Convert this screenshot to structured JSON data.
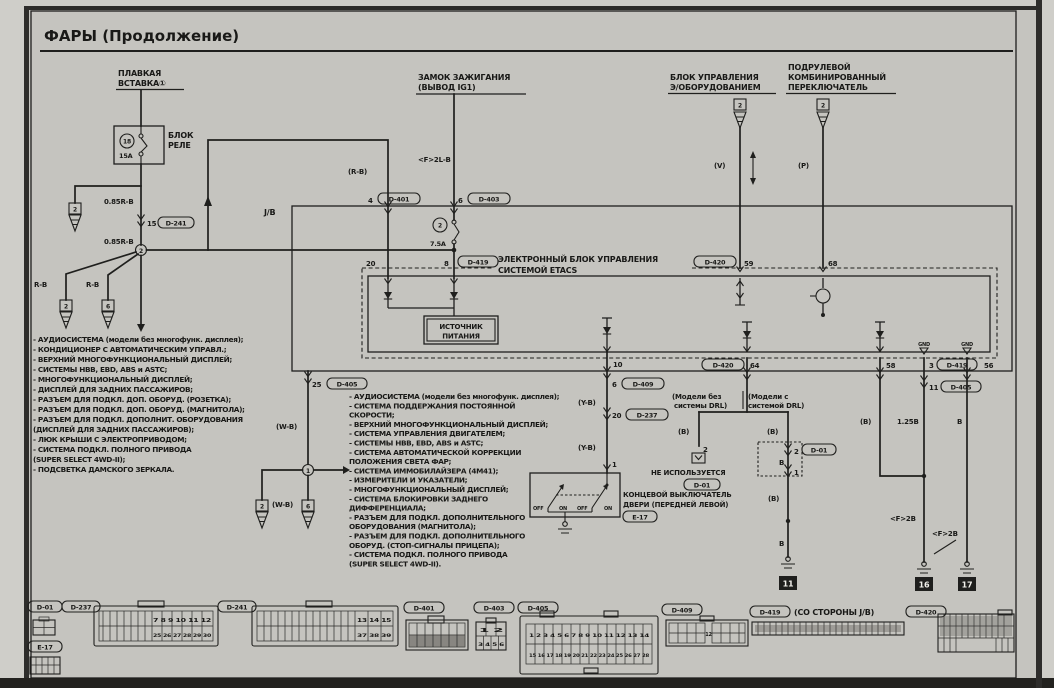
{
  "page": {
    "title": "ФАРЫ (Продолжение)"
  },
  "comp": {
    "fusible1": "ПЛАВКАЯ",
    "fusible2": "ВСТАВКА①",
    "relay1": "БЛОК",
    "relay2": "РЕЛЕ",
    "relay_fuse_no": "18",
    "relay_fuse_a": "15A",
    "ign1": "ЗАМОК ЗАЖИГАНИЯ",
    "ign2": "(ВЫВОД IG1)",
    "ecu1": "БЛОК УПРАВЛЕНИЯ",
    "ecu2": "Э/ОБОРУДОВАНИЕМ",
    "ecu_pin": "2",
    "col1": "ПОДРУЛЕВОЙ",
    "col2": "КОМБИНИРОВАННЫЙ",
    "col3": "ПЕРЕКЛЮЧАТЕЛЬ",
    "col_pin": "2",
    "jb": "J/B",
    "fuse2_no": "2",
    "fuse2_a": "7.5A",
    "etacs1": "ЭЛЕКТРОННЫЙ БЛОК УПРАВЛЕНИЯ",
    "etacs2": "СИСТЕМОЙ ETACS",
    "ps1": "ИСТОЧНИК",
    "ps2": "ПИТАНИЯ",
    "drl_a1": "(Модели без",
    "drl_a2": "системы DRL)",
    "drl_b1": "(Модели с",
    "drl_b2": "системой DRL)",
    "notused": "НЕ ИСПОЛЬЗУЕТСЯ",
    "notused_ref": "D-01",
    "door1": "КОНЦЕВОЙ ВЫКЛЮЧАТЕЛЬ",
    "door2": "ДВЕРИ (ПЕРЕДНЕЙ ЛЕВОЙ)",
    "door_ref": "E-17",
    "sw_off": "OFF",
    "sw_on": "ON",
    "gnd": "GND",
    "branch2": "2",
    "branch6": "6"
  },
  "wires": {
    "w085a": "0.85R-B",
    "w085b": "0.85R-B",
    "rb_l": "R-B",
    "rb_r": "R-B",
    "rb_p": "(R-B)",
    "f2lb": "<F>2L-B",
    "v": "(V)",
    "p": "(P)",
    "wb": "(W-B)",
    "yb": "(Y-B)",
    "b_par": "(B)",
    "b": "B",
    "b125": "1.25B",
    "f2b": "<F>2B"
  },
  "pins": {
    "p4": "4",
    "c401": "D-401",
    "p6": "6",
    "c403": "D-403",
    "p15": "15",
    "c241": "D-241",
    "p20": "20",
    "p8": "8",
    "c419": "D-419",
    "p59": "59",
    "c420": "D-420",
    "p68": "68",
    "p10": "10",
    "p6b": "6",
    "c409": "D-409",
    "p20b": "20",
    "c237": "D-237",
    "p1door": "1",
    "p25": "25",
    "c405": "D-405",
    "p64": "64",
    "p58": "58",
    "p3": "3",
    "p56": "56",
    "p11": "11",
    "p2a": "2",
    "p2b": "2",
    "c01": "D-01",
    "p1b": "1"
  },
  "grounds": {
    "g11": "11",
    "g16": "16",
    "g17": "17"
  },
  "lists": {
    "left": {
      "items": [
        "- АУДИОСИСТЕМА (модели без многофунк. дисплея);",
        "- КОНДИЦИОНЕР С АВТОМАТИЧЕСКИМ УПРАВЛ.;",
        "- ВЕРХНИЙ МНОГОФУНКЦИОНАЛЬНЫЙ ДИСПЛЕЙ;",
        "- СИСТЕМЫ HBB, EBD, ABS и ASTC;",
        "- МНОГОФУНКЦИОНАЛЬНЫЙ ДИСПЛЕЙ;",
        "- ДИСПЛЕЙ ДЛЯ ЗАДНИХ ПАССАЖИРОВ;",
        "- РАЗЪЕМ ДЛЯ ПОДКЛ. ДОП. ОБОРУД. (РОЗЕТКА);",
        "- РАЗЪЕМ ДЛЯ ПОДКЛ. ДОП. ОБОРУД. (МАГНИТОЛА);",
        "- РАЗЪЕМ ДЛЯ ПОДКЛ. ДОПОЛНИТ. ОБОРУДОВАНИЯ",
        "  (ДИСПЛЕЙ ДЛЯ ЗАДНИХ ПАССАЖИРОВ);",
        "- ЛЮК КРЫШИ С ЭЛЕКТРОПРИВОДОМ;",
        "- СИСТЕМА ПОДКЛ. ПОЛНОГО ПРИВОДА",
        "  (SUPER SELECT 4WD-II);",
        "- ПОДСВЕТКА ДАМСКОГО ЗЕРКАЛА."
      ]
    },
    "middle": {
      "items": [
        "- АУДИОСИСТЕМА (модели без многофунк. дисплея);",
        "- СИСТЕМА ПОДДЕРЖАНИЯ ПОСТОЯННОЙ",
        "  СКОРОСТИ;",
        "- ВЕРХНИЙ МНОГОФУНКЦИОНАЛЬНЫЙ ДИСПЛЕЙ;",
        "- СИСТЕМА УПРАВЛЕНИЯ ДВИГАТЕЛЕМ;",
        "- СИСТЕМЫ HBB, EBD, ABS и ASTC;",
        "- СИСТЕМА АВТОМАТИЧЕСКОЙ КОРРЕКЦИИ",
        "  ПОЛОЖЕНИЯ СВЕТА ФАР;",
        "- СИСТЕМА ИММОБИЛАЙЗЕРА (4M41);",
        "- ИЗМЕРИТЕЛИ И УКАЗАТЕЛИ;",
        "- МНОГОФУНКЦИОНАЛЬНЫЙ ДИСПЛЕЙ;",
        "- СИСТЕМА БЛОКИРОВКИ ЗАДНЕГО",
        "  ДИФФЕРЕНЦИАЛА;",
        "- РАЗЪЕМ ДЛЯ ПОДКЛ. ДОПОЛНИТЕЛЬНОГО",
        "  ОБОРУДОВАНИЯ (МАГНИТОЛА);",
        "- РАЗЪЕМ ДЛЯ ПОДКЛ. ДОПОЛНИТЕЛЬНОГО",
        "  ОБОРУД. (СТОП-СИГНАЛЫ ПРИЦЕПА);",
        "- СИСТЕМА ПОДКЛ. ПОЛНОГО ПРИВОДА",
        "  (SUPER SELECT 4WD-II)."
      ]
    }
  },
  "strip": {
    "d01": "D-01",
    "e17": "E-17",
    "d237": "D-237",
    "d237_top": "7 8 9 10 11 12",
    "d237_bot": "25 26 27 28 29 30",
    "d241": "D-241",
    "d241_top": "13 14 15",
    "d241_bot": "37 38 39",
    "d401": "D-401",
    "d403": "D-403",
    "d403_top": "1 2",
    "d403_bot": "3 4 5 6",
    "d405": "D-405",
    "d405_top": "1 2 3 4 5 6 7 8 9 10 11 12 13 14",
    "d405_bot": "15 16 17 18 19 20 21 22 23 24 25 26 27 28",
    "d409": "D-409",
    "d409_center": "12",
    "d419": "D-419",
    "d419_note": "(СО СТОРОНЫ J/B)",
    "d420": "D-420"
  }
}
